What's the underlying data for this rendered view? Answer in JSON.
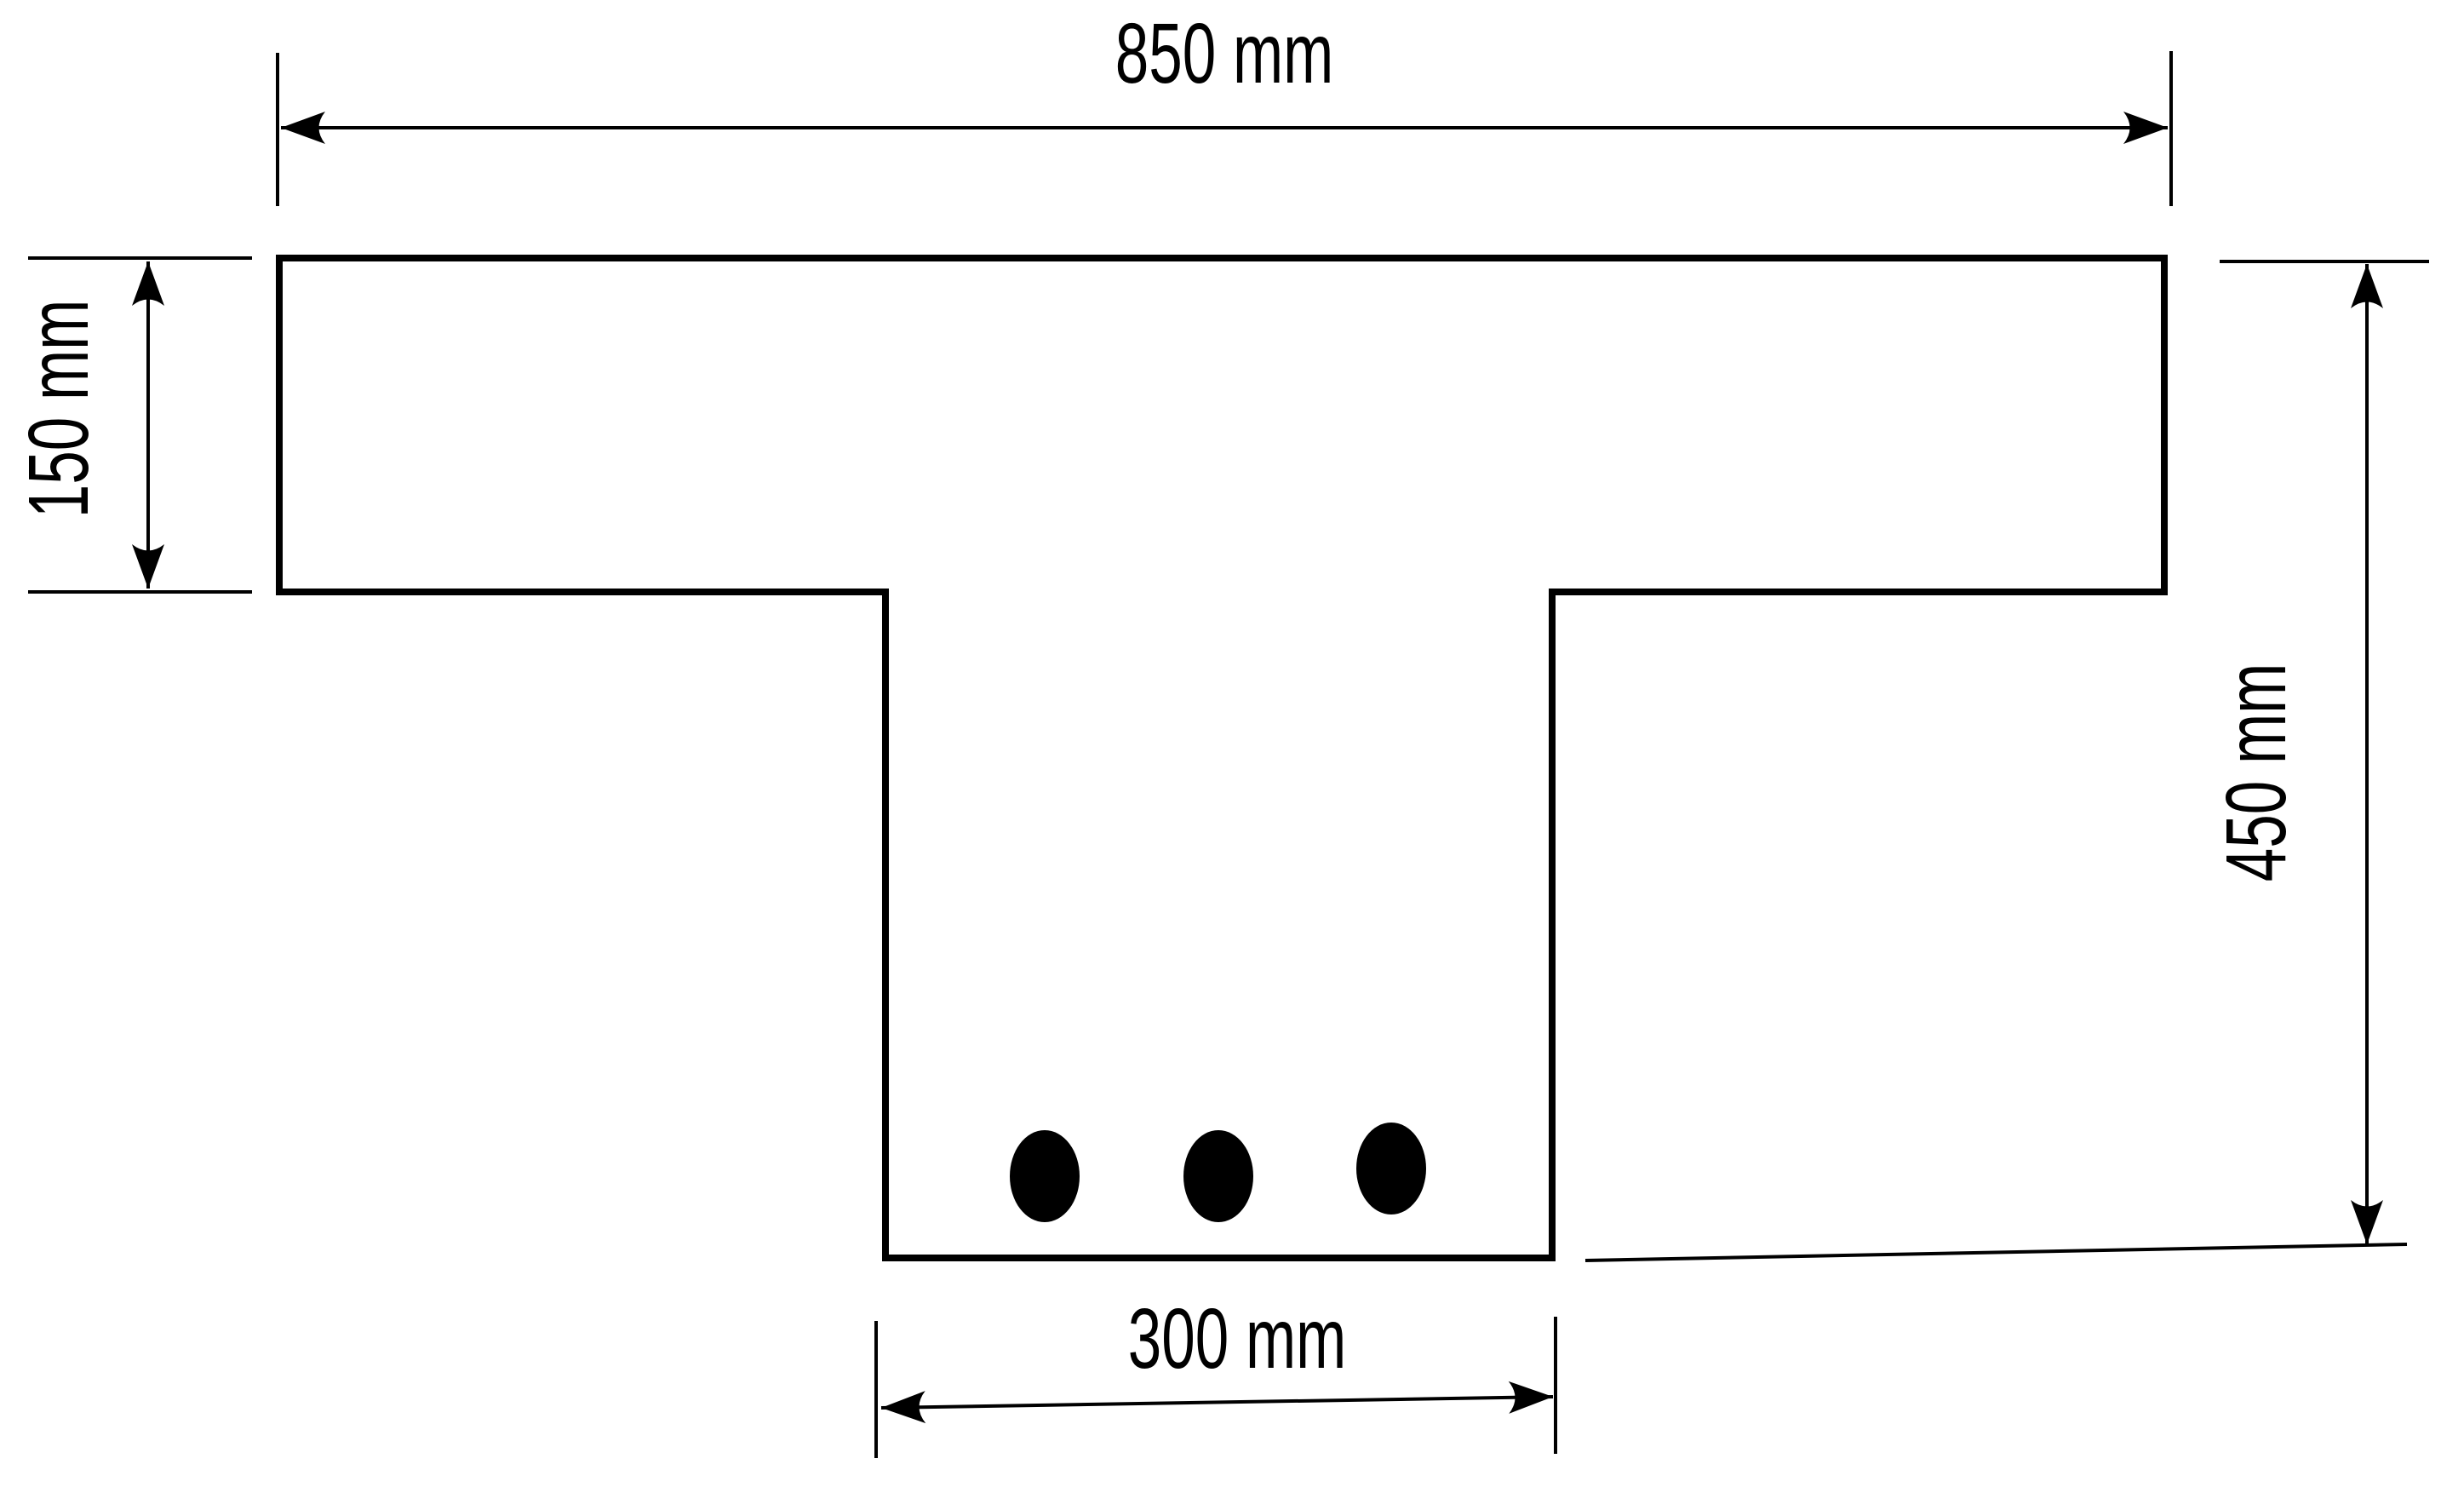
{
  "page": {
    "background_color": "#ffffff",
    "ink_color": "#000000"
  },
  "drawing": {
    "shape": "T-beam cross-section",
    "rebar_count": 3
  },
  "dimensions": {
    "flange_width": {
      "label": "850 mm",
      "value": 850,
      "unit": "mm",
      "orientation": "horizontal"
    },
    "flange_thickness": {
      "label": "150 mm",
      "value": 150,
      "unit": "mm",
      "orientation": "vertical"
    },
    "overall_depth": {
      "label": "450 mm",
      "value": 450,
      "unit": "mm",
      "orientation": "vertical"
    },
    "web_width": {
      "label": "300 mm",
      "value": 300,
      "unit": "mm",
      "orientation": "horizontal"
    }
  }
}
